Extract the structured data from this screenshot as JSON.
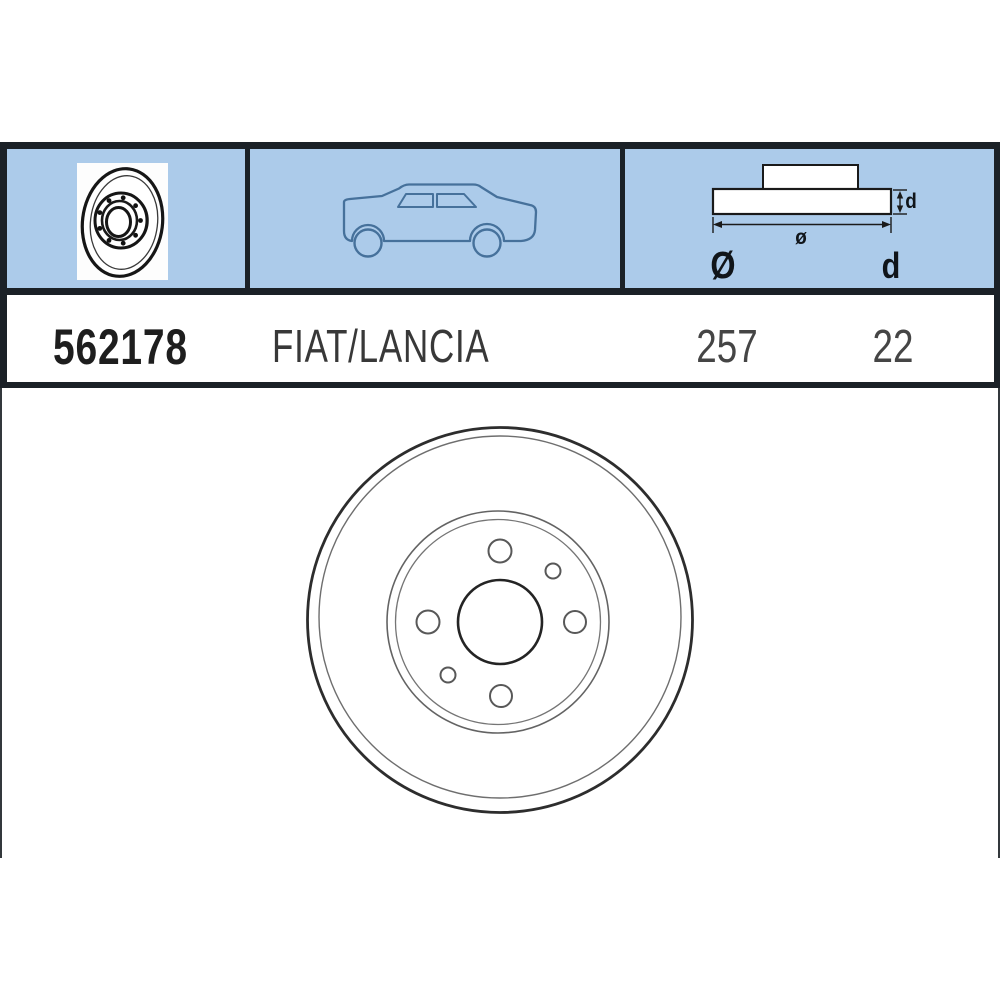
{
  "part": {
    "number": "562178",
    "application": "FIAT/LANCIA",
    "outer_diameter": "257",
    "thickness": "22"
  },
  "diagram": {
    "dim_diameter_small": "ø",
    "dim_thickness_small": "d",
    "col_diameter_symbol": "Ø",
    "col_thickness_symbol": "d"
  },
  "icons": {
    "thumbnail": "brake-disc-perspective-icon",
    "vehicle": "car-side-silhouette-icon",
    "cross_section": "disc-cross-section-diagram",
    "main_drawing": "brake-disc-front-view-drawing"
  },
  "colors": {
    "header_background": "#accbea",
    "border": "#1b2127",
    "car_line": "#46719b",
    "text_dark": "#1e1e1e",
    "text_gray": "#454545"
  }
}
